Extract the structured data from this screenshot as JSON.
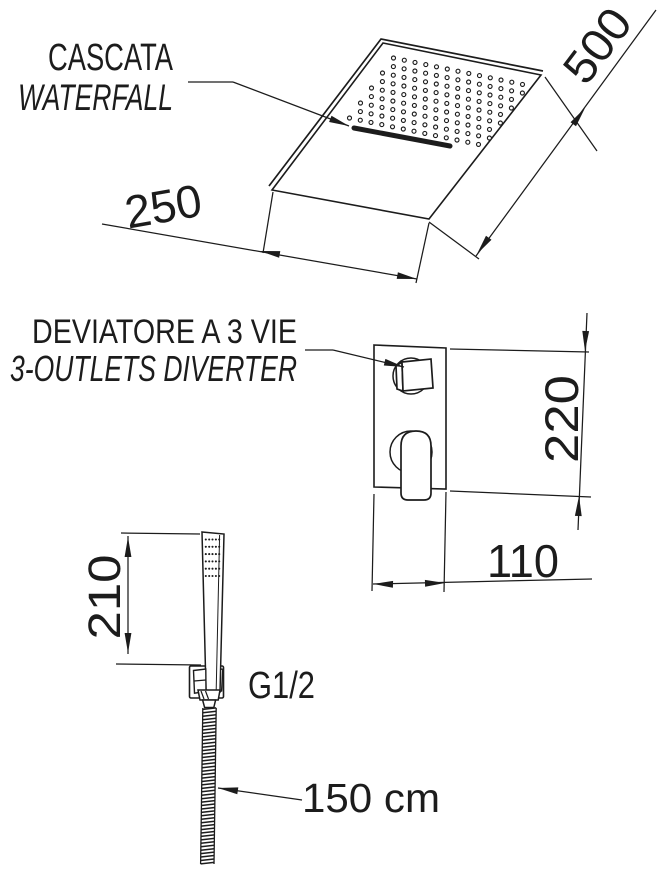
{
  "colors": {
    "ink": "#1c1c1c",
    "paper": "#ffffff"
  },
  "waterfall_head": {
    "label_it": "CASCATA",
    "label_en": "WATERFALL",
    "width_mm": "250",
    "depth_mm": "500"
  },
  "diverter": {
    "label_it": "DEVIATORE A 3 VIE",
    "label_en": "3-OUTLETS DIVERTER",
    "height_mm": "220",
    "width_mm": "110"
  },
  "hand_shower": {
    "height_mm": "210",
    "connection": "G1/2",
    "hose_length": "150 cm"
  }
}
